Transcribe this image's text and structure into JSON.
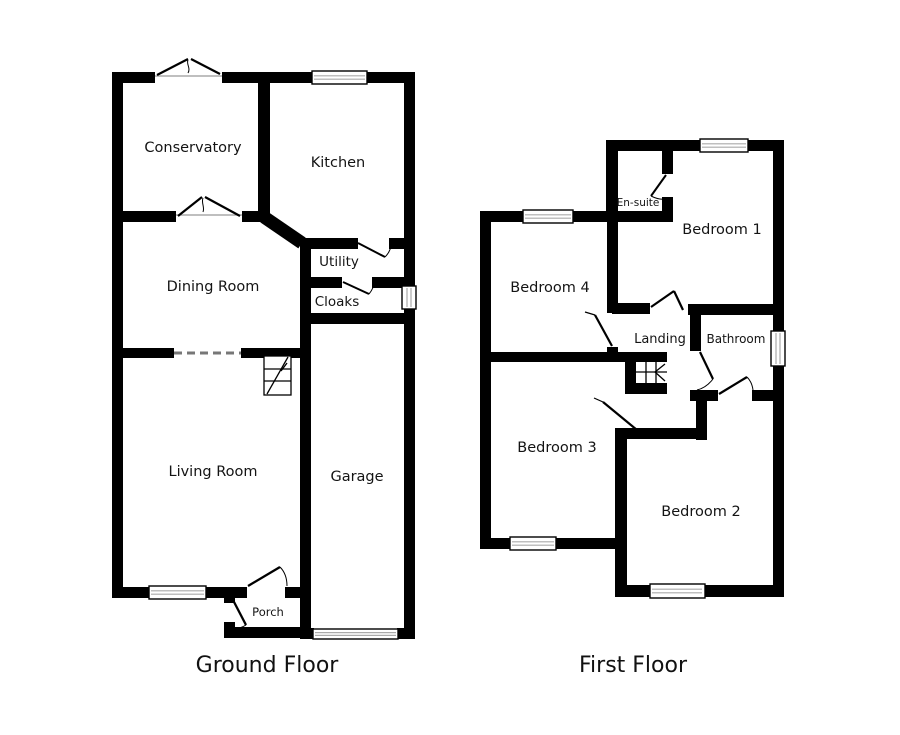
{
  "colors": {
    "wall": "#000000",
    "background": "#ffffff",
    "window_stripe": "#aaaaaa",
    "text": "#141414"
  },
  "ground_floor": {
    "title": "Ground Floor",
    "rooms": {
      "conservatory": "Conservatory",
      "kitchen": "Kitchen",
      "dining_room": "Dining Room",
      "utility": "Utility",
      "cloaks": "Cloaks",
      "living_room": "Living Room",
      "garage": "Garage",
      "porch": "Porch"
    }
  },
  "first_floor": {
    "title": "First Floor",
    "rooms": {
      "en_suite": "En-suite",
      "bedroom_1": "Bedroom 1",
      "bedroom_4": "Bedroom 4",
      "landing": "Landing",
      "bathroom": "Bathroom",
      "bedroom_3": "Bedroom 3",
      "bedroom_2": "Bedroom 2"
    }
  }
}
